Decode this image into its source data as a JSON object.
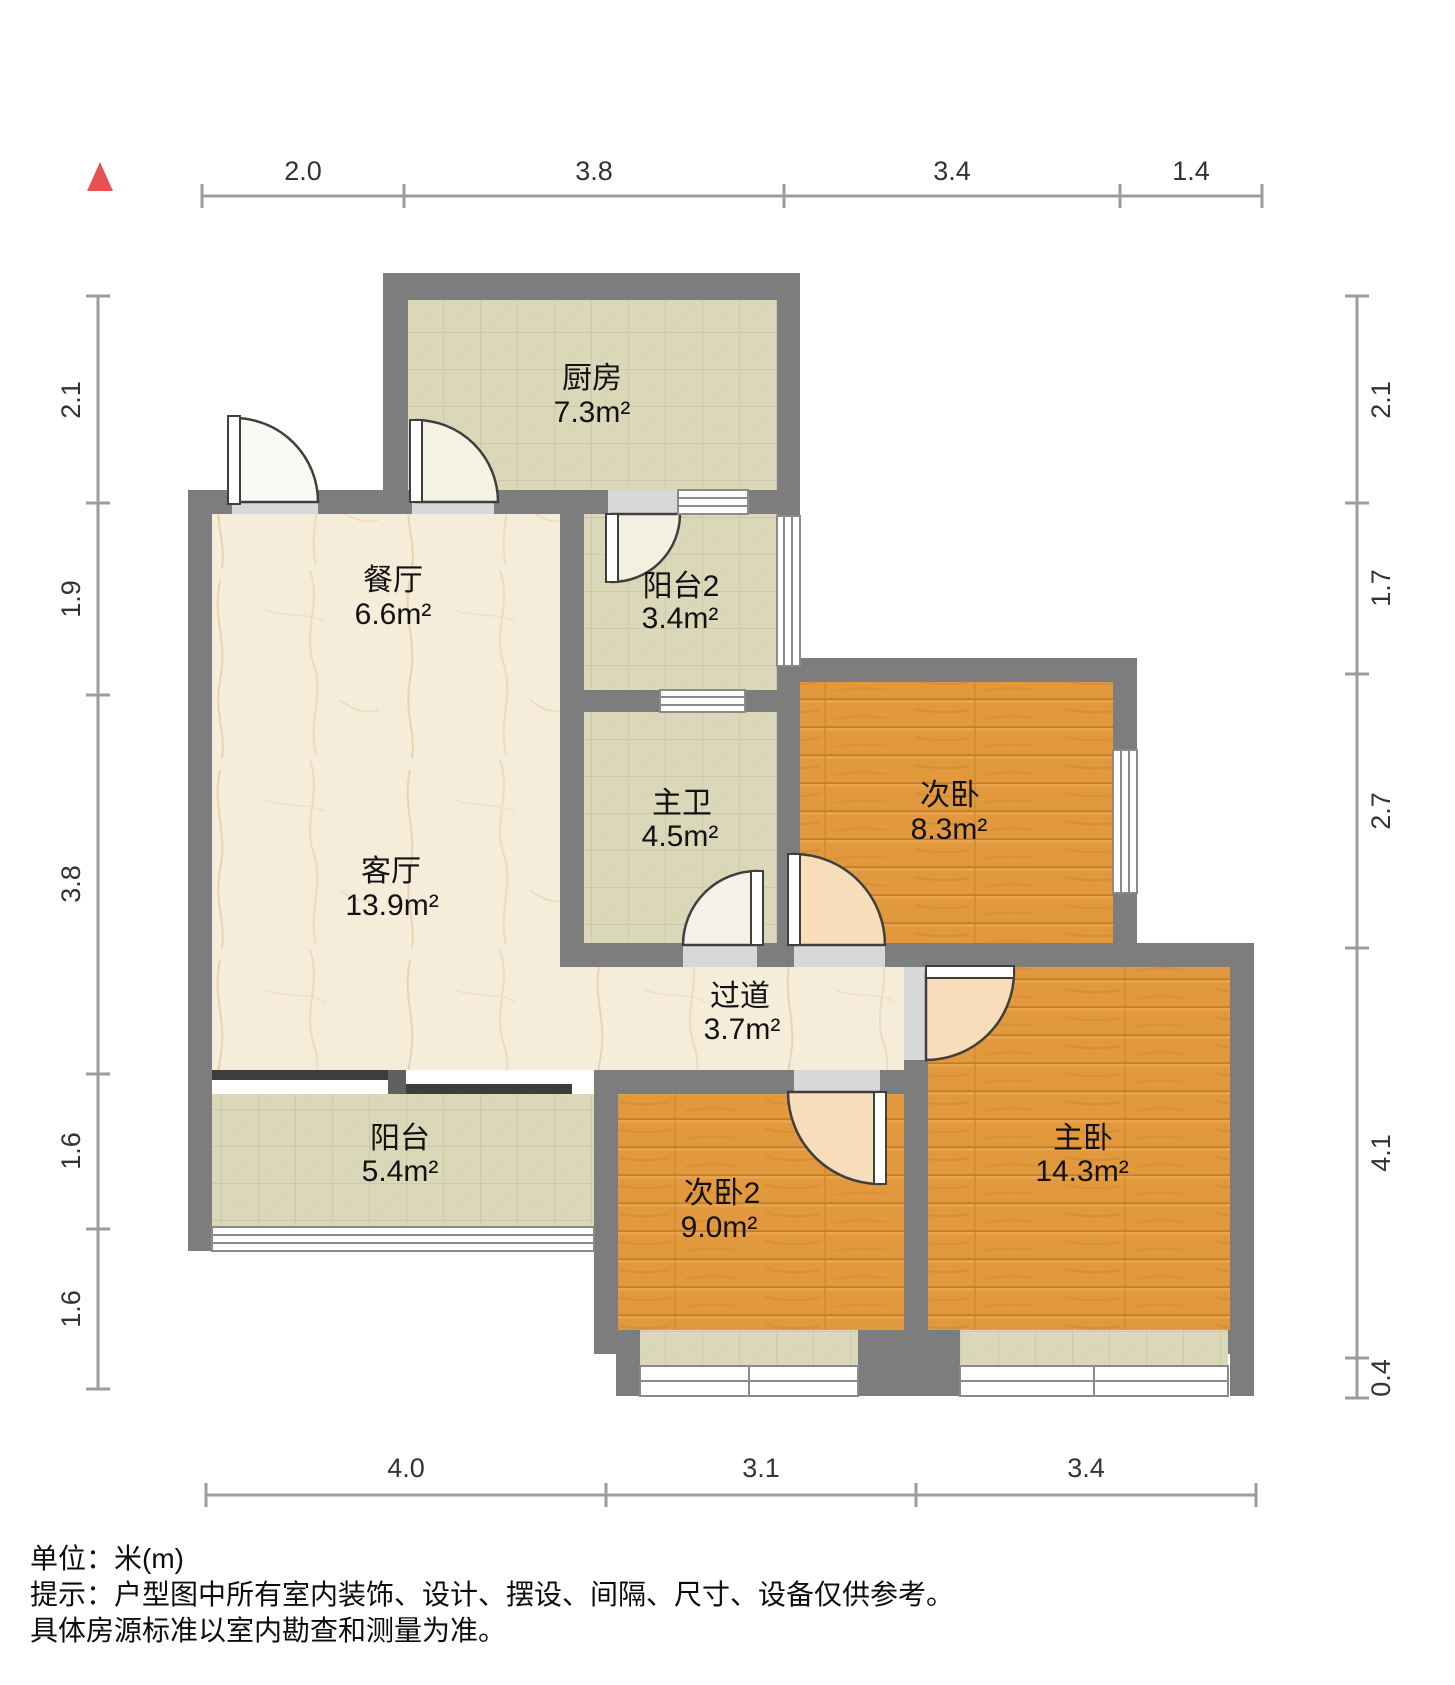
{
  "plan": {
    "rooms": [
      {
        "id": "kitchen",
        "name": "厨房",
        "area": "7.3m²",
        "floor": "tile"
      },
      {
        "id": "dining",
        "name": "餐厅",
        "area": "6.6m²",
        "floor": "marble"
      },
      {
        "id": "balcony2",
        "name": "阳台2",
        "area": "3.4m²",
        "floor": "tile"
      },
      {
        "id": "master-bath",
        "name": "主卫",
        "area": "4.5m²",
        "floor": "tile"
      },
      {
        "id": "second-bedroom",
        "name": "次卧",
        "area": "8.3m²",
        "floor": "wood"
      },
      {
        "id": "living",
        "name": "客厅",
        "area": "13.9m²",
        "floor": "marble"
      },
      {
        "id": "hallway",
        "name": "过道",
        "area": "3.7m²",
        "floor": "marble"
      },
      {
        "id": "balcony",
        "name": "阳台",
        "area": "5.4m²",
        "floor": "tile"
      },
      {
        "id": "second-bedroom-2",
        "name": "次卧2",
        "area": "9.0m²",
        "floor": "wood"
      },
      {
        "id": "master-bedroom",
        "name": "主卧",
        "area": "14.3m²",
        "floor": "wood"
      }
    ],
    "dimensions": {
      "top": [
        "2.0",
        "3.8",
        "3.4",
        "1.4"
      ],
      "bottom": [
        "4.0",
        "3.1",
        "3.4"
      ],
      "left": [
        "2.1",
        "1.9",
        "3.8",
        "1.6",
        "1.6"
      ],
      "right": [
        "2.1",
        "1.7",
        "2.7",
        "4.1",
        "0.4"
      ]
    },
    "notes": [
      "单位：米(m)",
      "提示：户型图中所有室内装饰、设计、摆设、间隔、尺寸、设备仅供参考。",
      "具体房源标准以室内勘查和测量为准。"
    ],
    "colors": {
      "wall": "#7d7d7d",
      "wood_floor": "#e2993e",
      "tile_floor": "#dad8b9",
      "marble_floor": "#f5ecd9",
      "north_arrow": "#e85050"
    }
  }
}
